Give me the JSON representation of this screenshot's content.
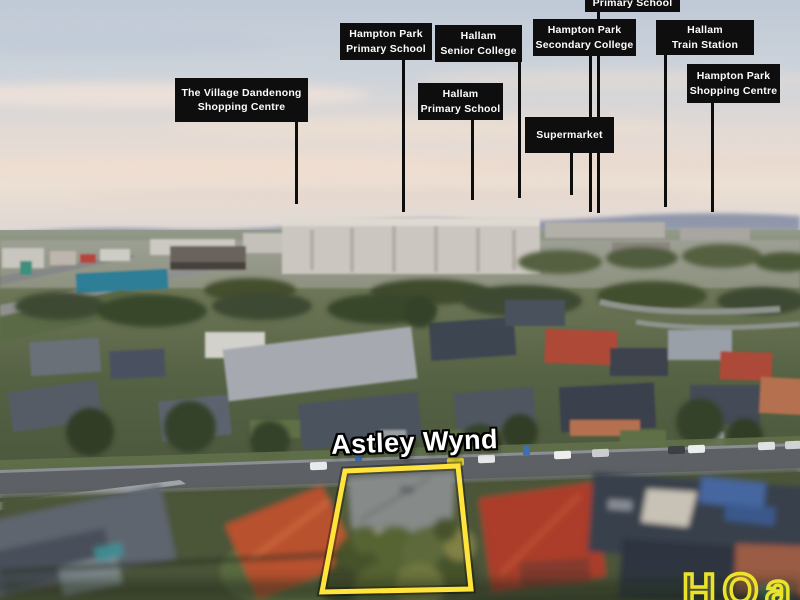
{
  "scene": {
    "street_label": "Astley Wynd",
    "watermark": "HOa"
  },
  "colors": {
    "label_bg": "#0e0e0e",
    "label_text": "#fdfdfd",
    "pointer_line": "#0d0d0d",
    "boundary_yellow": "#ffe53b",
    "watermark_yellow": "#ebe22c",
    "street_text": "#ffffff",
    "sky_top": "#c0cad7",
    "sky_pink": "#eddfd4",
    "road_gray": "#5d6166",
    "roof_red": "#b04938",
    "roof_slate": "#3c434e",
    "foliage_green": "#46523a"
  },
  "labels": [
    {
      "id": "village-dandenong-shopping-centre",
      "lines": [
        "The Village Dandenong",
        "Shopping Centre"
      ],
      "box": {
        "left": 175,
        "top": 78,
        "width": 133,
        "height": 44
      },
      "line": {
        "x": 296,
        "to": 204
      }
    },
    {
      "id": "hampton-park-primary-school",
      "lines": [
        "Hampton Park",
        "Primary School"
      ],
      "box": {
        "left": 340,
        "top": 23,
        "width": 92,
        "height": 37
      },
      "line": {
        "x": 403,
        "to": 212
      }
    },
    {
      "id": "hallam-senior-college",
      "lines": [
        "Hallam",
        "Senior College"
      ],
      "box": {
        "left": 435,
        "top": 25,
        "width": 87,
        "height": 37
      },
      "line": {
        "x": 519,
        "to": 198
      }
    },
    {
      "id": "hallam-primary-school",
      "lines": [
        "Hallam",
        "Primary School"
      ],
      "box": {
        "left": 418,
        "top": 83,
        "width": 85,
        "height": 37
      },
      "line": {
        "x": 472,
        "to": 200
      }
    },
    {
      "id": "top-partial-primary-school",
      "lines": [
        "Primary School"
      ],
      "clipped": true,
      "box": {
        "left": 585,
        "top": -26,
        "width": 95,
        "height": 38
      },
      "line": {
        "x": 598,
        "to": 213
      }
    },
    {
      "id": "hampton-park-secondary-college",
      "lines": [
        "Hampton Park",
        "Secondary College"
      ],
      "box": {
        "left": 533,
        "top": 19,
        "width": 103,
        "height": 37
      },
      "line": {
        "x": 590,
        "to": 212
      }
    },
    {
      "id": "hallam-train-station",
      "lines": [
        "Hallam",
        "Train Station"
      ],
      "box": {
        "left": 656,
        "top": 20,
        "width": 98,
        "height": 35
      },
      "line": {
        "x": 665,
        "to": 207
      }
    },
    {
      "id": "supermarket",
      "lines": [
        "Supermarket"
      ],
      "box": {
        "left": 525,
        "top": 117,
        "width": 89,
        "height": 36
      },
      "line": {
        "x": 571,
        "to": 195
      }
    },
    {
      "id": "hampton-park-shopping-centre",
      "lines": [
        "Hampton Park",
        "Shopping Centre"
      ],
      "box": {
        "left": 687,
        "top": 64,
        "width": 93,
        "height": 39
      },
      "line": {
        "x": 712,
        "to": 212
      }
    }
  ],
  "boundary": {
    "points": [
      [
        345,
        471
      ],
      [
        458,
        466
      ],
      [
        471,
        589
      ],
      [
        322,
        592
      ]
    ]
  }
}
